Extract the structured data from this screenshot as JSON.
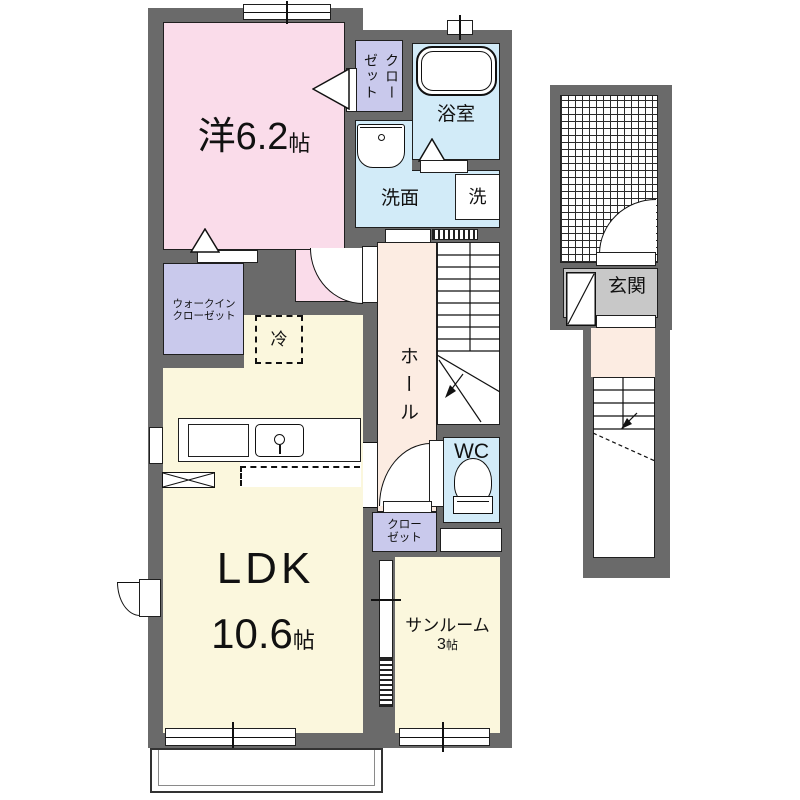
{
  "title": "apartment-floor-plan",
  "colors": {
    "wall": "#6a6a6a",
    "western_room": "#fadcea",
    "closet": "#c9c9ec",
    "wet_area": "#d2ebf8",
    "hall": "#fcece2",
    "ldk": "#fbf7dd",
    "entrance_floor": "#c8c8c8",
    "line": "#111111"
  },
  "rooms": {
    "western": {
      "label": "洋6.2",
      "unit": "帖"
    },
    "closet_top": {
      "col_right": "クロー",
      "col_left": "ゼット"
    },
    "bath": {
      "label": "浴室"
    },
    "washroom": {
      "label": "洗面"
    },
    "washer": {
      "label": "洗"
    },
    "wic": {
      "line1": "ウォークイン",
      "line2": "クローゼット"
    },
    "fridge": {
      "label": "冷"
    },
    "hall": {
      "label": "ホール"
    },
    "wc": {
      "label": "WC"
    },
    "closet_hall": {
      "line1": "クロー",
      "line2": "ゼット"
    },
    "ldk": {
      "label": "LDK",
      "size": "10.6",
      "unit": "帖"
    },
    "sunroom": {
      "label": "サンルーム",
      "size": "3",
      "unit": "帖"
    },
    "entrance": {
      "label": "玄関"
    }
  }
}
